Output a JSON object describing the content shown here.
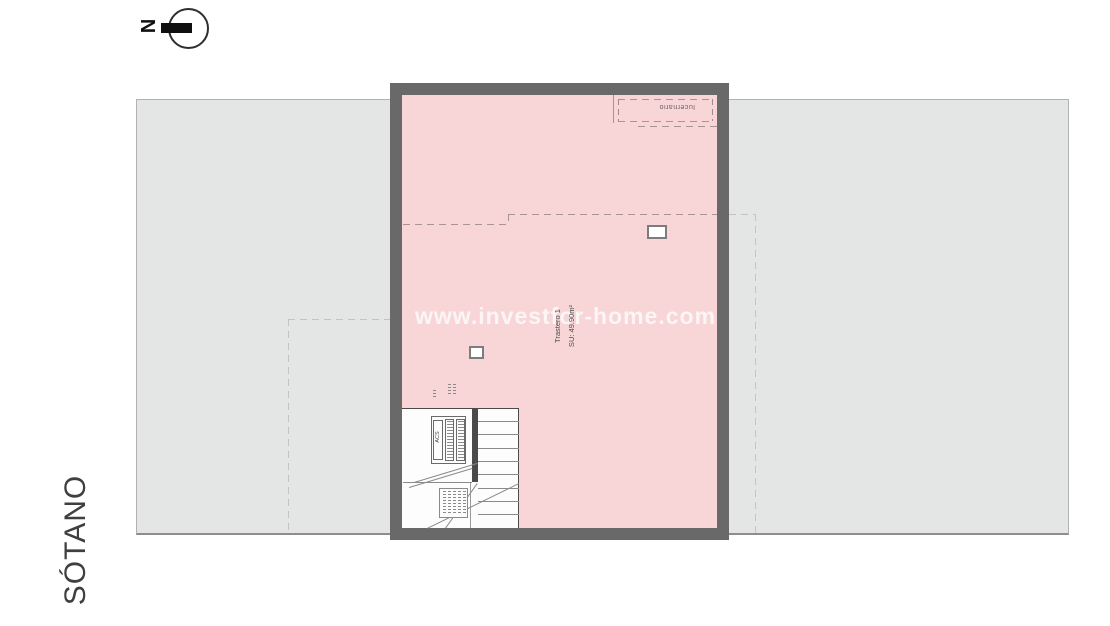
{
  "north": {
    "label": "N"
  },
  "floor_label": "SÓTANO",
  "watermark": "www.investfor-home.com",
  "plan": {
    "skylight": {
      "label": "lucernario"
    },
    "room": {
      "name": "Trastero 1",
      "area": "SU: 49.90m²"
    },
    "equipment": {
      "acs": "ACS"
    }
  },
  "colors": {
    "room_fill": "#f8d6d7",
    "wall": "#696969",
    "site_fill": "#e4e5e5"
  }
}
